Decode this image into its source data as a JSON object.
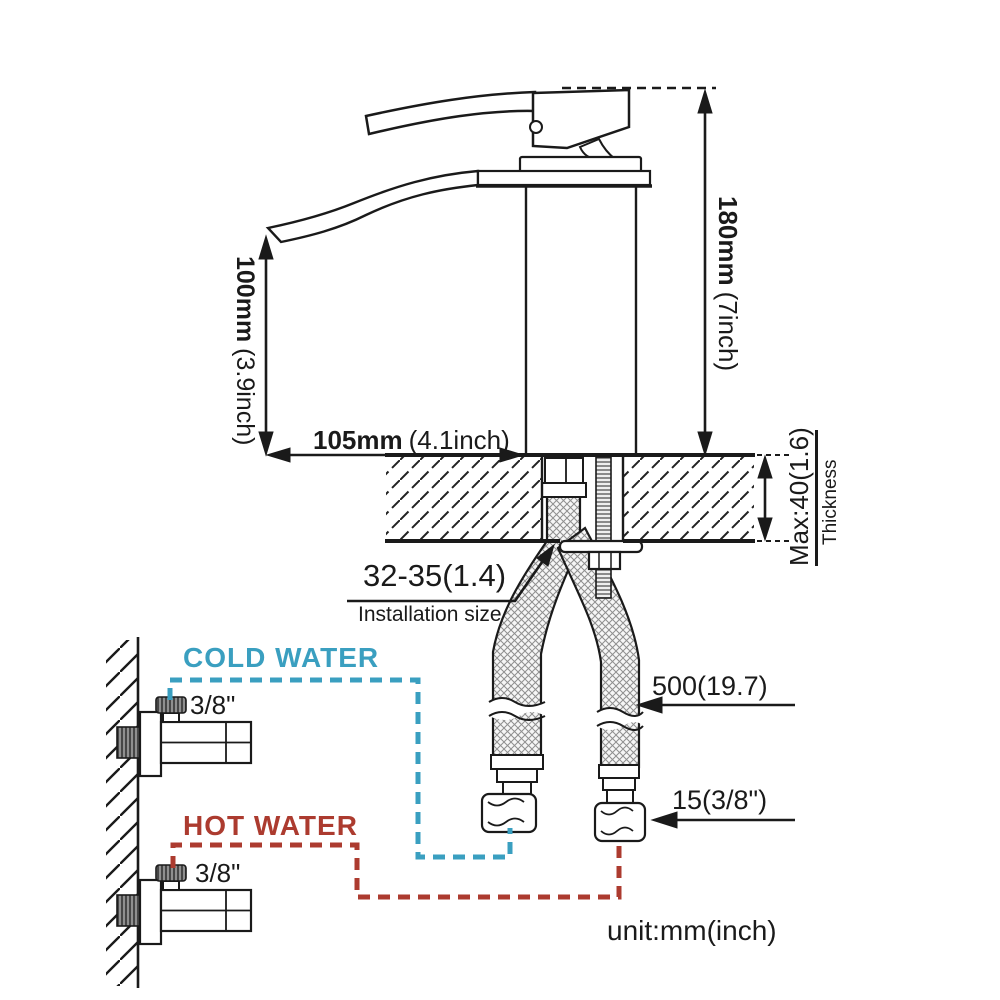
{
  "colors": {
    "cold": "#3a9fc0",
    "hot": "#ac3b2f",
    "line": "#1a1a1a"
  },
  "dimensions": {
    "spout_height": {
      "value": "100mm",
      "alt": "(3.9inch)"
    },
    "total_height": {
      "value": "180mm",
      "alt": "(7inch)"
    },
    "spout_reach": {
      "value": "105mm",
      "alt": "(4.1inch)"
    },
    "counter_thickness": {
      "value": "Max:40(1.6)",
      "label": "Thickness"
    },
    "installation_hole": {
      "value": "32-35(1.4)",
      "label": "Installation size"
    },
    "hose_length": {
      "value": "500(19.7)"
    },
    "hose_connector": {
      "value": "15(3/8\")"
    }
  },
  "supply": {
    "cold": {
      "label": "COLD WATER",
      "size": "3/8\""
    },
    "hot": {
      "label": "HOT WATER",
      "size": "3/8\""
    }
  },
  "note": {
    "unit": "unit:mm(inch)"
  }
}
